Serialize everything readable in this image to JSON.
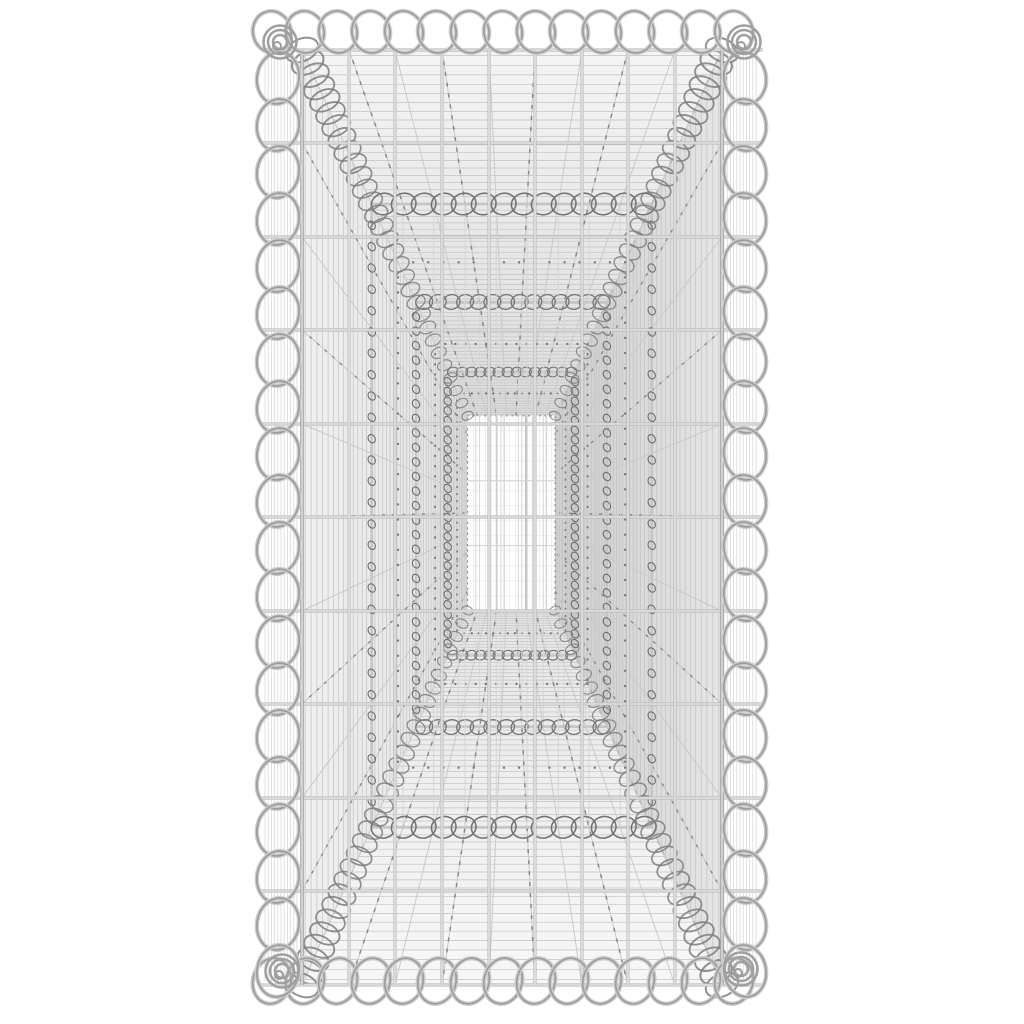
{
  "scene": {
    "description": "Product photo: empty galvanized steel gabion basket viewed frontally down its length; spiral-bound edges, wire mesh walls receding in perspective to a small bright back panel.",
    "canvas": {
      "w": 1024,
      "h": 1024,
      "bg": "#ffffff"
    },
    "vp": {
      "x": 511,
      "y": 512
    },
    "front": {
      "l": 302,
      "r": 722,
      "t": 50,
      "b": 985
    },
    "z_far": 4.8,
    "partitions_z": [
      3.3,
      2.2,
      1.5
    ],
    "lace_z": [
      1.85,
      2.75,
      3.9
    ],
    "front_wires": {
      "verticals": [
        302,
        349,
        395,
        442,
        489,
        535,
        582,
        628,
        675,
        722
      ],
      "horizontals": [
        50,
        143,
        237,
        330,
        424,
        517,
        611,
        704,
        798,
        891,
        985
      ]
    },
    "back_grid": {
      "v_step": 6,
      "h_step": 15
    },
    "spirals": {
      "top": {
        "x0": 272,
        "step": 33,
        "n": 15,
        "cy": 32,
        "rx": 19,
        "ry": 21,
        "rot": -15
      },
      "bottom": {
        "x0": 272,
        "step": 33,
        "n": 15,
        "cy": 981,
        "rx": 19,
        "ry": 23,
        "rot": 15
      },
      "left": {
        "y0": 78,
        "step": 47,
        "n": 20,
        "cx": 278,
        "rx": 21,
        "ry": 26,
        "rot": 10
      },
      "right": {
        "y0": 78,
        "step": 47,
        "n": 20,
        "cx": 745,
        "rx": 21,
        "ry": 26,
        "rot": -10
      }
    },
    "corner_knots": [
      [
        280,
        42
      ],
      [
        744,
        42
      ],
      [
        282,
        971
      ],
      [
        741,
        969
      ]
    ],
    "colors": {
      "bg": "#ffffff",
      "wall_left_near": "#f0f0f0",
      "wall_left_far": "#e2e2e2",
      "wall_right_near": "#e6e6e6",
      "wall_right_far": "#cccccc",
      "ceiling_near": "#f4f4f4",
      "ceiling_far": "#dcdcdc",
      "floor_near": "#f7f7f7",
      "floor_far": "#e6e6e6",
      "hatch": "#c2c2c2",
      "hatch_soft": "#d8d8d8",
      "converge_solid": "#c9c9c9",
      "converge_dash": "#878787",
      "lace_dot": "#787878",
      "coil_dark": "#757575",
      "hook": "#6c6c6c",
      "band": "#7e7e7e",
      "wire_base": "#bdbdbd",
      "wire_core": "#f3f3f3",
      "wire_edge": "#a3a3a3",
      "spiral_light": "#cdcdcd",
      "spiral_dark": "#9c9c9c",
      "knot": "#a0a0a0",
      "back_line_faint": "#e4e4e4",
      "back_line_mid": "#b5b5b5",
      "back_h_faint": "#e9e9e9",
      "back_h_mid": "#d0d0d0",
      "back_border": "#909090",
      "partition_frame": "#c6c6c6",
      "partition_inner": "#d6d6d6"
    }
  }
}
